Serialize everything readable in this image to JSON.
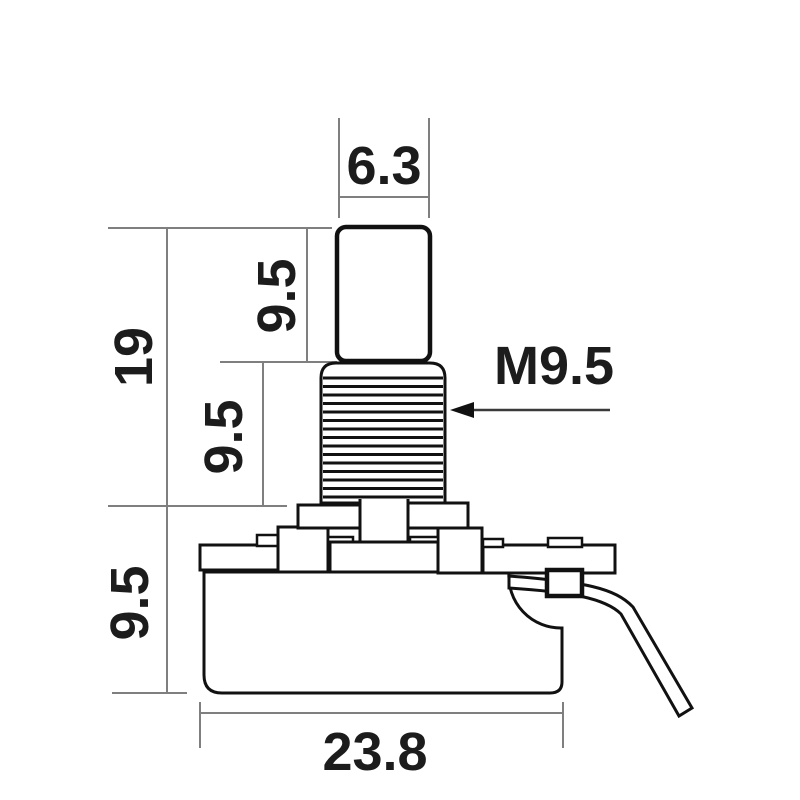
{
  "colors": {
    "background": "#ffffff",
    "outline": "#111111",
    "dimension_lines": "#7f7f7f",
    "text": "#1c1c1c"
  },
  "dimensions": {
    "shaft_diameter": "6.3",
    "shaft_height": "9.5",
    "thread_height": "9.5",
    "overall_height": "19",
    "body_height": "9.5",
    "body_width": "23.8",
    "thread_spec": "M9.5"
  }
}
